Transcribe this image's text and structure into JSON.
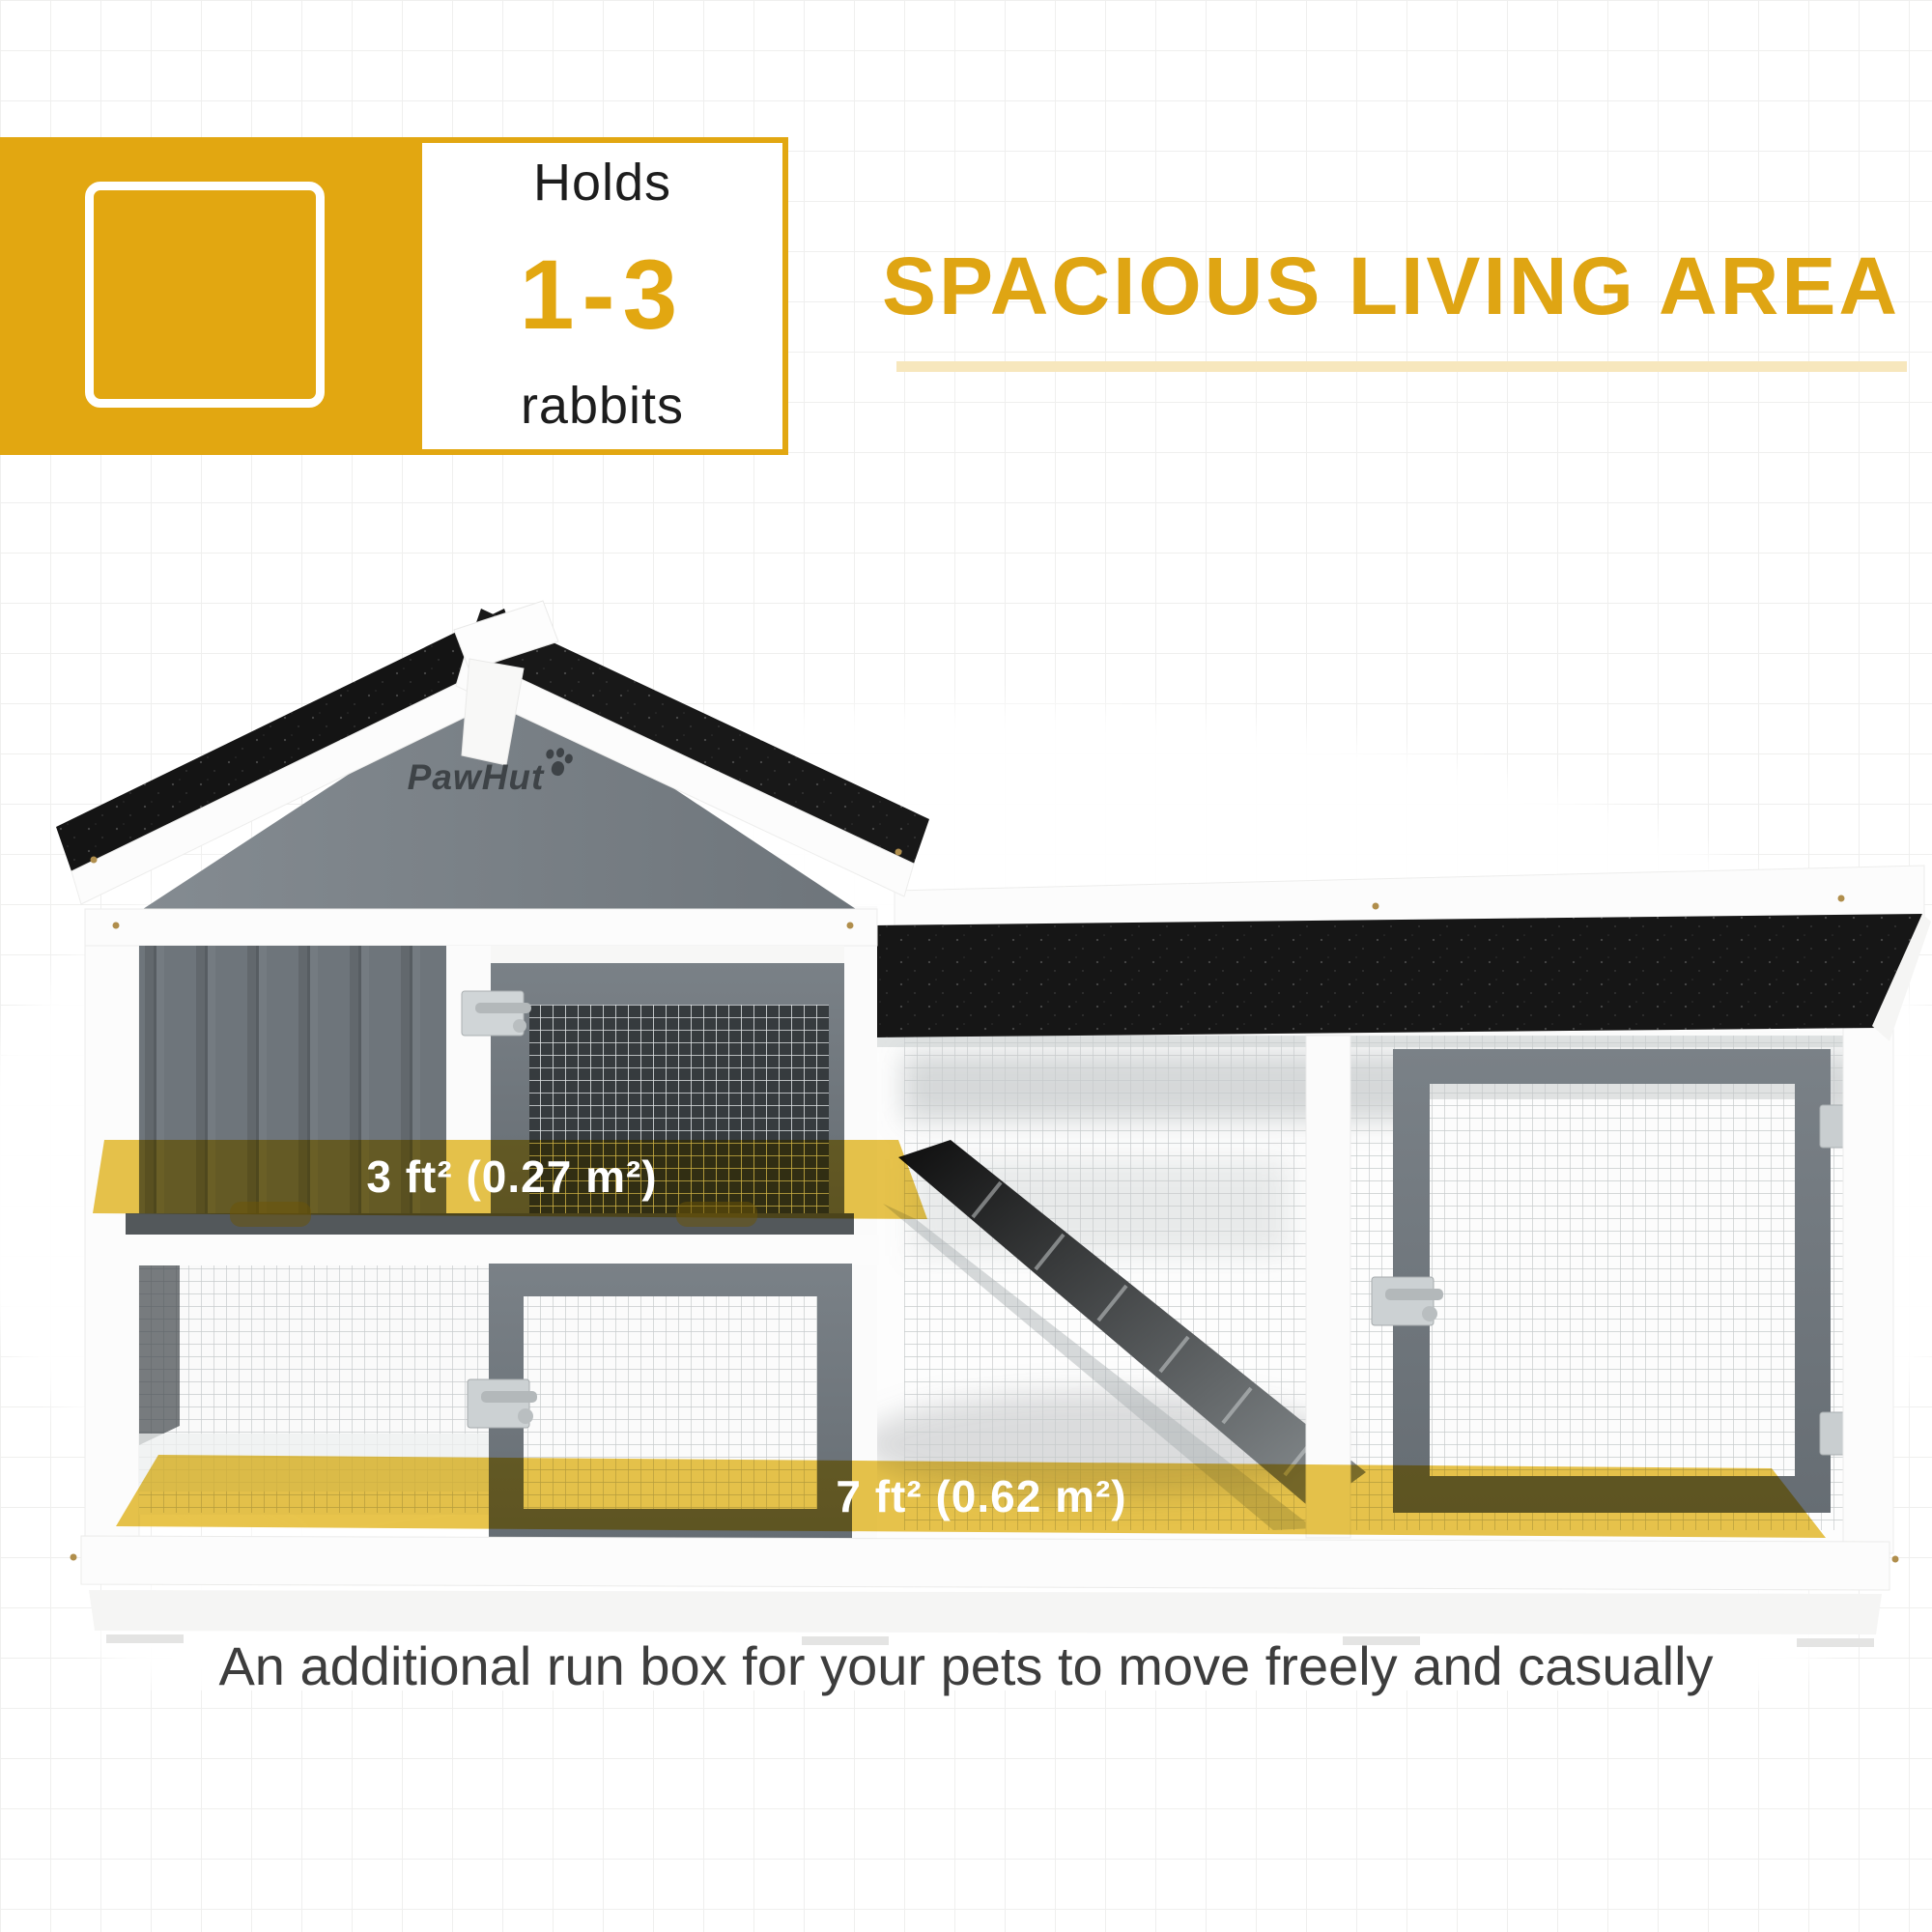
{
  "capacity_badge": {
    "holds_label": "Holds",
    "range": "1-3",
    "animal_label": "rabbits"
  },
  "headline": {
    "text": "SPACIOUS LIVING AREA"
  },
  "hutch": {
    "brand": "PawHut",
    "upper_level_area": "3 ft² (0.27 m²)",
    "run_area": "7 ft² (0.62 m²)"
  },
  "caption": "An additional run box for your pets to move freely and casually",
  "colors": {
    "brand_gold": "#e2a711",
    "headline_gold": "#dfa513",
    "underline_pale_gold": "#f7e7bd",
    "area_band_overlay": "#e6be37",
    "roof_black": "#161616",
    "wood_grey": "#6d747a",
    "caption_text": "#3d3d3d"
  }
}
